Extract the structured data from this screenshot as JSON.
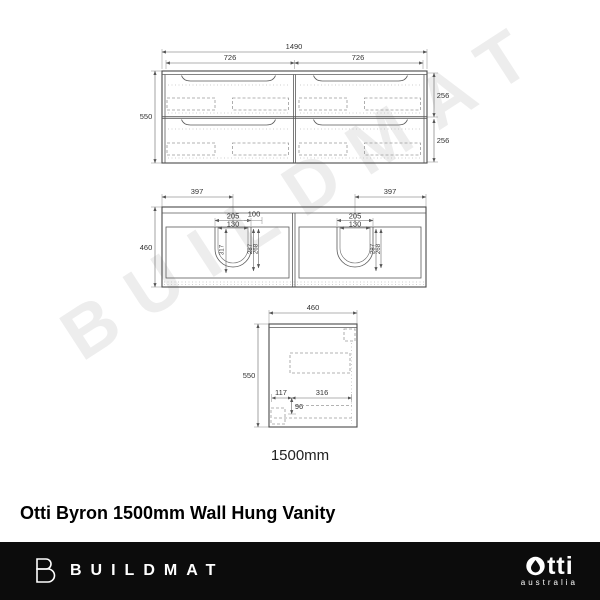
{
  "watermark_text": "BUILDMAT",
  "drawings": {
    "front": {
      "total_width": "1490",
      "left_drawer_width": "726",
      "right_drawer_width": "726",
      "height": "550",
      "top_drawer_height": "256",
      "bottom_drawer_height": "256"
    },
    "plan": {
      "left_basin_offset": "397",
      "right_basin_offset": "397",
      "depth": "460",
      "left": {
        "basin_width": "205",
        "waste_width": "130",
        "tap_offset": "100",
        "basin_depth": "317",
        "dim_a": "287",
        "dim_b": "268"
      },
      "right": {
        "basin_width": "205",
        "waste_width": "130",
        "dim_a": "287",
        "dim_b": "268"
      }
    },
    "side": {
      "depth": "460",
      "height": "550",
      "back_dim": "117",
      "mid_dim": "316",
      "drop_dim": "96"
    },
    "scale_label": "1500mm"
  },
  "title": "Otti Byron 1500mm Wall Hung Vanity",
  "footer": {
    "brand": "BUILDMAT",
    "partner": "otti",
    "partner_sub": "australia",
    "bar_color": "#0c0c0c"
  }
}
